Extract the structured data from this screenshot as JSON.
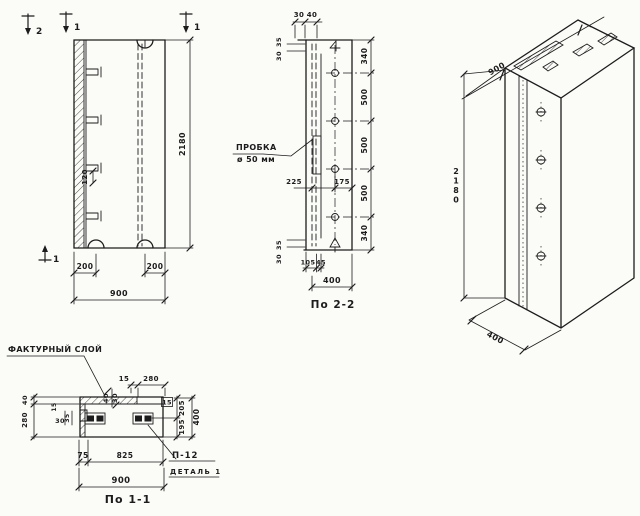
{
  "drawing": {
    "paper_color": "#fbfbf8",
    "ink_color": "#1c1c1c",
    "views": {
      "elevation": {
        "dim_height": "2180",
        "dim_width": "900",
        "dim_notch_left": "200",
        "dim_notch_right": "200",
        "dim_hook": "120",
        "marker_cut2_top": "2",
        "marker_cut1_left": "1",
        "marker_cut1_right": "1",
        "marker_cut2_bottom": "1"
      },
      "section22": {
        "title": "По 2-2",
        "plug_line1": "ПРОБКА",
        "plug_line2": "ø 50 мм",
        "dim_top_a": "30",
        "dim_top_b": "40",
        "dim_corner_top_a": "30",
        "dim_corner_top_b": "35",
        "dim_corner_bot_a": "30",
        "dim_corner_bot_b": "35",
        "chain": [
          "340",
          "500",
          "500",
          "500",
          "340"
        ],
        "dim_plug_front": "225",
        "dim_plug_back": "175",
        "dim_foot_a": "105",
        "dim_foot_b": "45",
        "dim_depth": "400"
      },
      "isometric": {
        "dim_width": "900",
        "dim_height": "2180",
        "dim_depth": "400"
      },
      "section11": {
        "title": "По 1-1",
        "label_texture": "ФАКТУРНЫЙ СЛОЙ",
        "label_detail_code": "П-12",
        "label_detail_name": "ДЕТАЛЬ 1",
        "dim_top_gap": "15",
        "dim_top_span": "280",
        "dim_layer_a": "40",
        "dim_layer_b": "30",
        "dim_left_a": "40",
        "dim_left_b": "280",
        "dim_joint_a": "15",
        "dim_joint_b": "30",
        "dim_joint_c": "35",
        "dim_ref_box": "15",
        "dim_right_a": "205",
        "dim_right_b": "195",
        "dim_right_total": "400",
        "dim_bottom_a": "75",
        "dim_bottom_b": "825",
        "dim_bottom_total": "900"
      }
    }
  }
}
